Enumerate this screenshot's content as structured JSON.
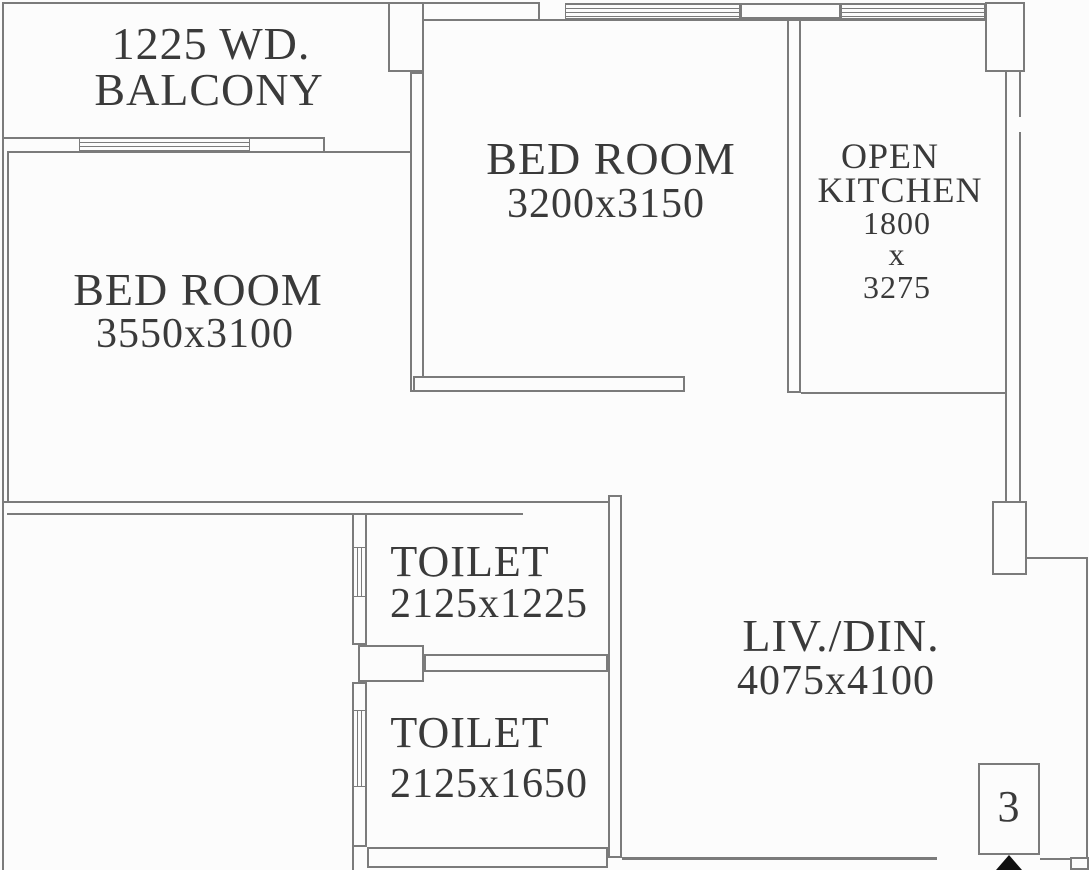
{
  "plan": {
    "type": "apartment-floor-plan",
    "unit": {
      "number": "3"
    },
    "rooms": [
      {
        "id": "balcony",
        "lines": [
          "1225 WD.",
          "BALCONY"
        ]
      },
      {
        "id": "bedroom-1",
        "lines": [
          "BED ROOM",
          "3550x3100"
        ]
      },
      {
        "id": "bedroom-2",
        "lines": [
          "BED ROOM",
          "3200x3150"
        ]
      },
      {
        "id": "open-kitchen",
        "lines": [
          "OPEN",
          "KITCHEN",
          "1800",
          "x",
          "3275"
        ]
      },
      {
        "id": "toilet-1",
        "lines": [
          "TOILET",
          "2125x1225"
        ]
      },
      {
        "id": "toilet-2",
        "lines": [
          "TOILET",
          "2125x1650"
        ]
      },
      {
        "id": "living-dining",
        "lines": [
          "LIV./DIN.",
          "4075x4100"
        ]
      }
    ],
    "colors": {
      "line": "#7b7b7b",
      "text": "#3a3a3a",
      "arrow": "#111111",
      "background": "#fcfcfc"
    }
  }
}
